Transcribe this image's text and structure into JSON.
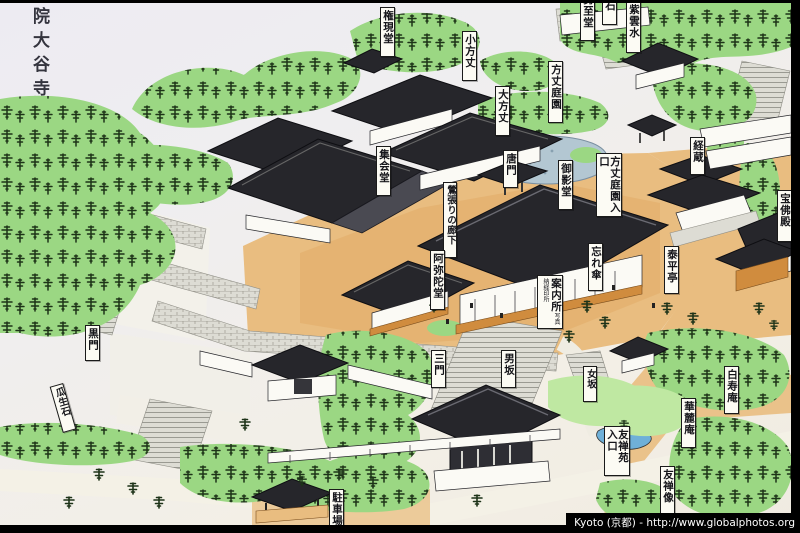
{
  "title": {
    "text": "院大谷寺"
  },
  "labels": {
    "gongendo": "権現堂",
    "seishido": "勢至堂",
    "ishi_partial": "石",
    "shiunsui": "紫雲水",
    "kohojo": "小方丈",
    "ohojo": "大方丈",
    "hojo_teien": "方丈庭園",
    "kyozo": "経蔵",
    "karamon": "唐門",
    "mieido": "御影堂",
    "hojo_teien_iriguchi": "方丈庭園入口",
    "shukaido": "集会堂",
    "uguisubari_no_roka": "鶯張りの廊下",
    "amidado": "阿弥陀堂",
    "wasuregasa": "忘れ傘",
    "taiheitei": "泰平亭",
    "hobutsuden": "宝佛殿",
    "annaijo": "案内所",
    "annaijo_sub": "写真納経印所",
    "sanmon": "三門",
    "otokozaka": "男坂",
    "onnazaka": "女坂",
    "hakujuan": "白寿庵",
    "karokuan": "華麓庵",
    "yuzenen_iriguchi": "友禅苑入口",
    "yuzenzo": "友禅像",
    "kuromon": "黒門",
    "uryuseki": "瓜生石",
    "chushajo": "駐車場"
  },
  "watermark": {
    "text": "Kyoto (京都) - http://www.globalphotos.org"
  },
  "colors": {
    "frame": "#000000",
    "paper": "#efedf0",
    "green": "#9bd783",
    "green_light": "#bfe8a2",
    "pine": "#1d3318",
    "tan": "#e9bd80",
    "tan_deep": "#e2a964",
    "roof": "#26262b",
    "roof_light": "#4a4a52",
    "wall": "#fbfaf5",
    "stone": "#dddcd4",
    "stone_line": "#8f8e86",
    "water": "#b3c7d2",
    "water_deep": "#6fb0d8",
    "orange_wall": "#d08c3e",
    "ink": "#1a1a1a",
    "label_bg": "#fcfbf4"
  }
}
